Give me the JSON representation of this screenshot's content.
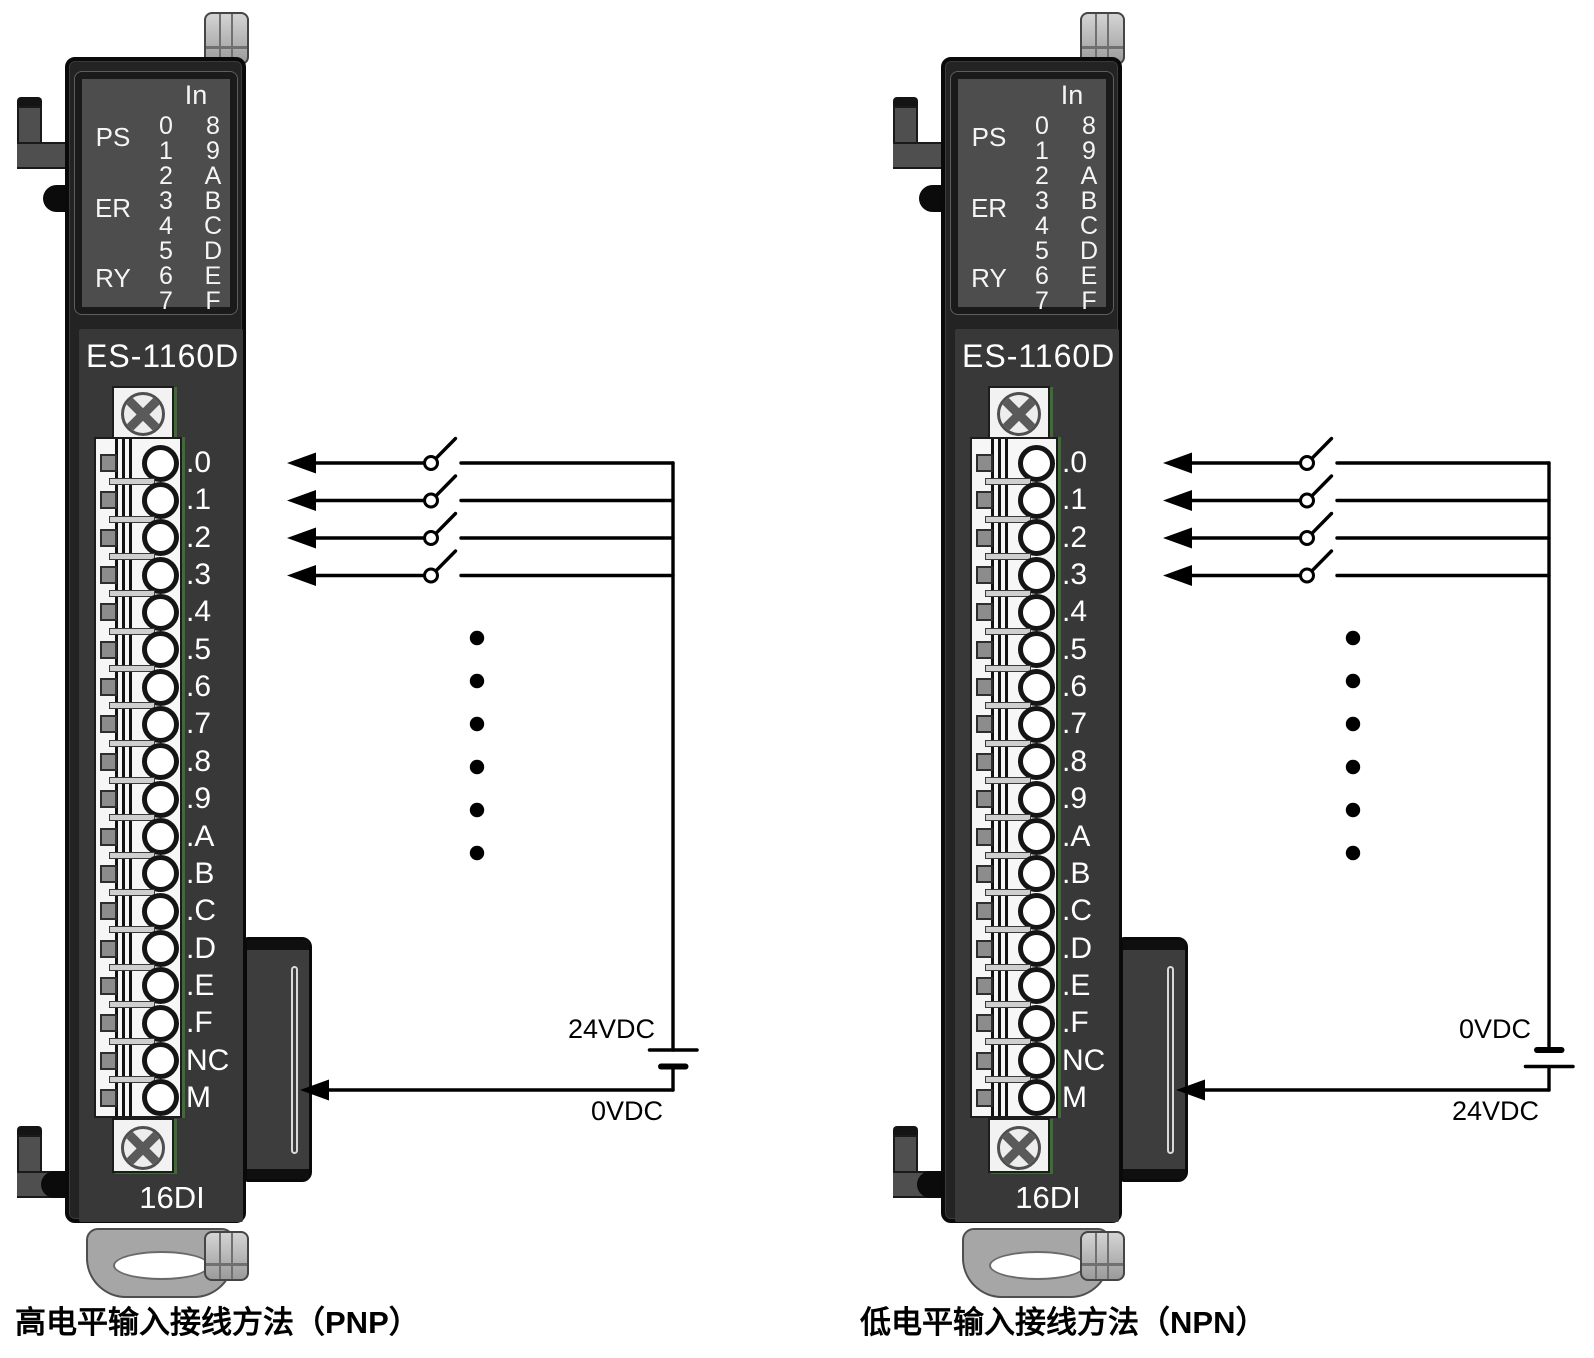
{
  "colors": {
    "module_body": "#262626",
    "module_face": "#383838",
    "led_panel": "#4d4d4d",
    "label_text": "#ffffff",
    "wire": "#000000",
    "pcb_edge": "#3f6b34"
  },
  "panels": [
    {
      "id": "pnp",
      "model": "ES-1160D",
      "type_label": "16DI",
      "led": {
        "header": "In",
        "status_labels": [
          "PS",
          "ER",
          "RY"
        ],
        "col_left": [
          "0",
          "1",
          "2",
          "3",
          "4",
          "5",
          "6",
          "7"
        ],
        "col_right": [
          "8",
          "9",
          "A",
          "B",
          "C",
          "D",
          "E",
          "F"
        ]
      },
      "terminals": [
        ".0",
        ".1",
        ".2",
        ".3",
        ".4",
        ".5",
        ".6",
        ".7",
        ".8",
        ".9",
        ".A",
        ".B",
        ".C",
        ".D",
        ".E",
        ".F",
        "NC",
        "M"
      ],
      "wiring": {
        "polarity": "pnp",
        "supply_top_label": "24VDC",
        "supply_bottom_label": "0VDC"
      },
      "caption": "高电平输入接线方法（PNP）"
    },
    {
      "id": "npn",
      "model": "ES-1160D",
      "type_label": "16DI",
      "led": {
        "header": "In",
        "status_labels": [
          "PS",
          "ER",
          "RY"
        ],
        "col_left": [
          "0",
          "1",
          "2",
          "3",
          "4",
          "5",
          "6",
          "7"
        ],
        "col_right": [
          "8",
          "9",
          "A",
          "B",
          "C",
          "D",
          "E",
          "F"
        ]
      },
      "terminals": [
        ".0",
        ".1",
        ".2",
        ".3",
        ".4",
        ".5",
        ".6",
        ".7",
        ".8",
        ".9",
        ".A",
        ".B",
        ".C",
        ".D",
        ".E",
        ".F",
        "NC",
        "M"
      ],
      "wiring": {
        "polarity": "npn",
        "supply_top_label": "0VDC",
        "supply_bottom_label": "24VDC"
      },
      "caption": "低电平输入接线方法（NPN）"
    }
  ]
}
